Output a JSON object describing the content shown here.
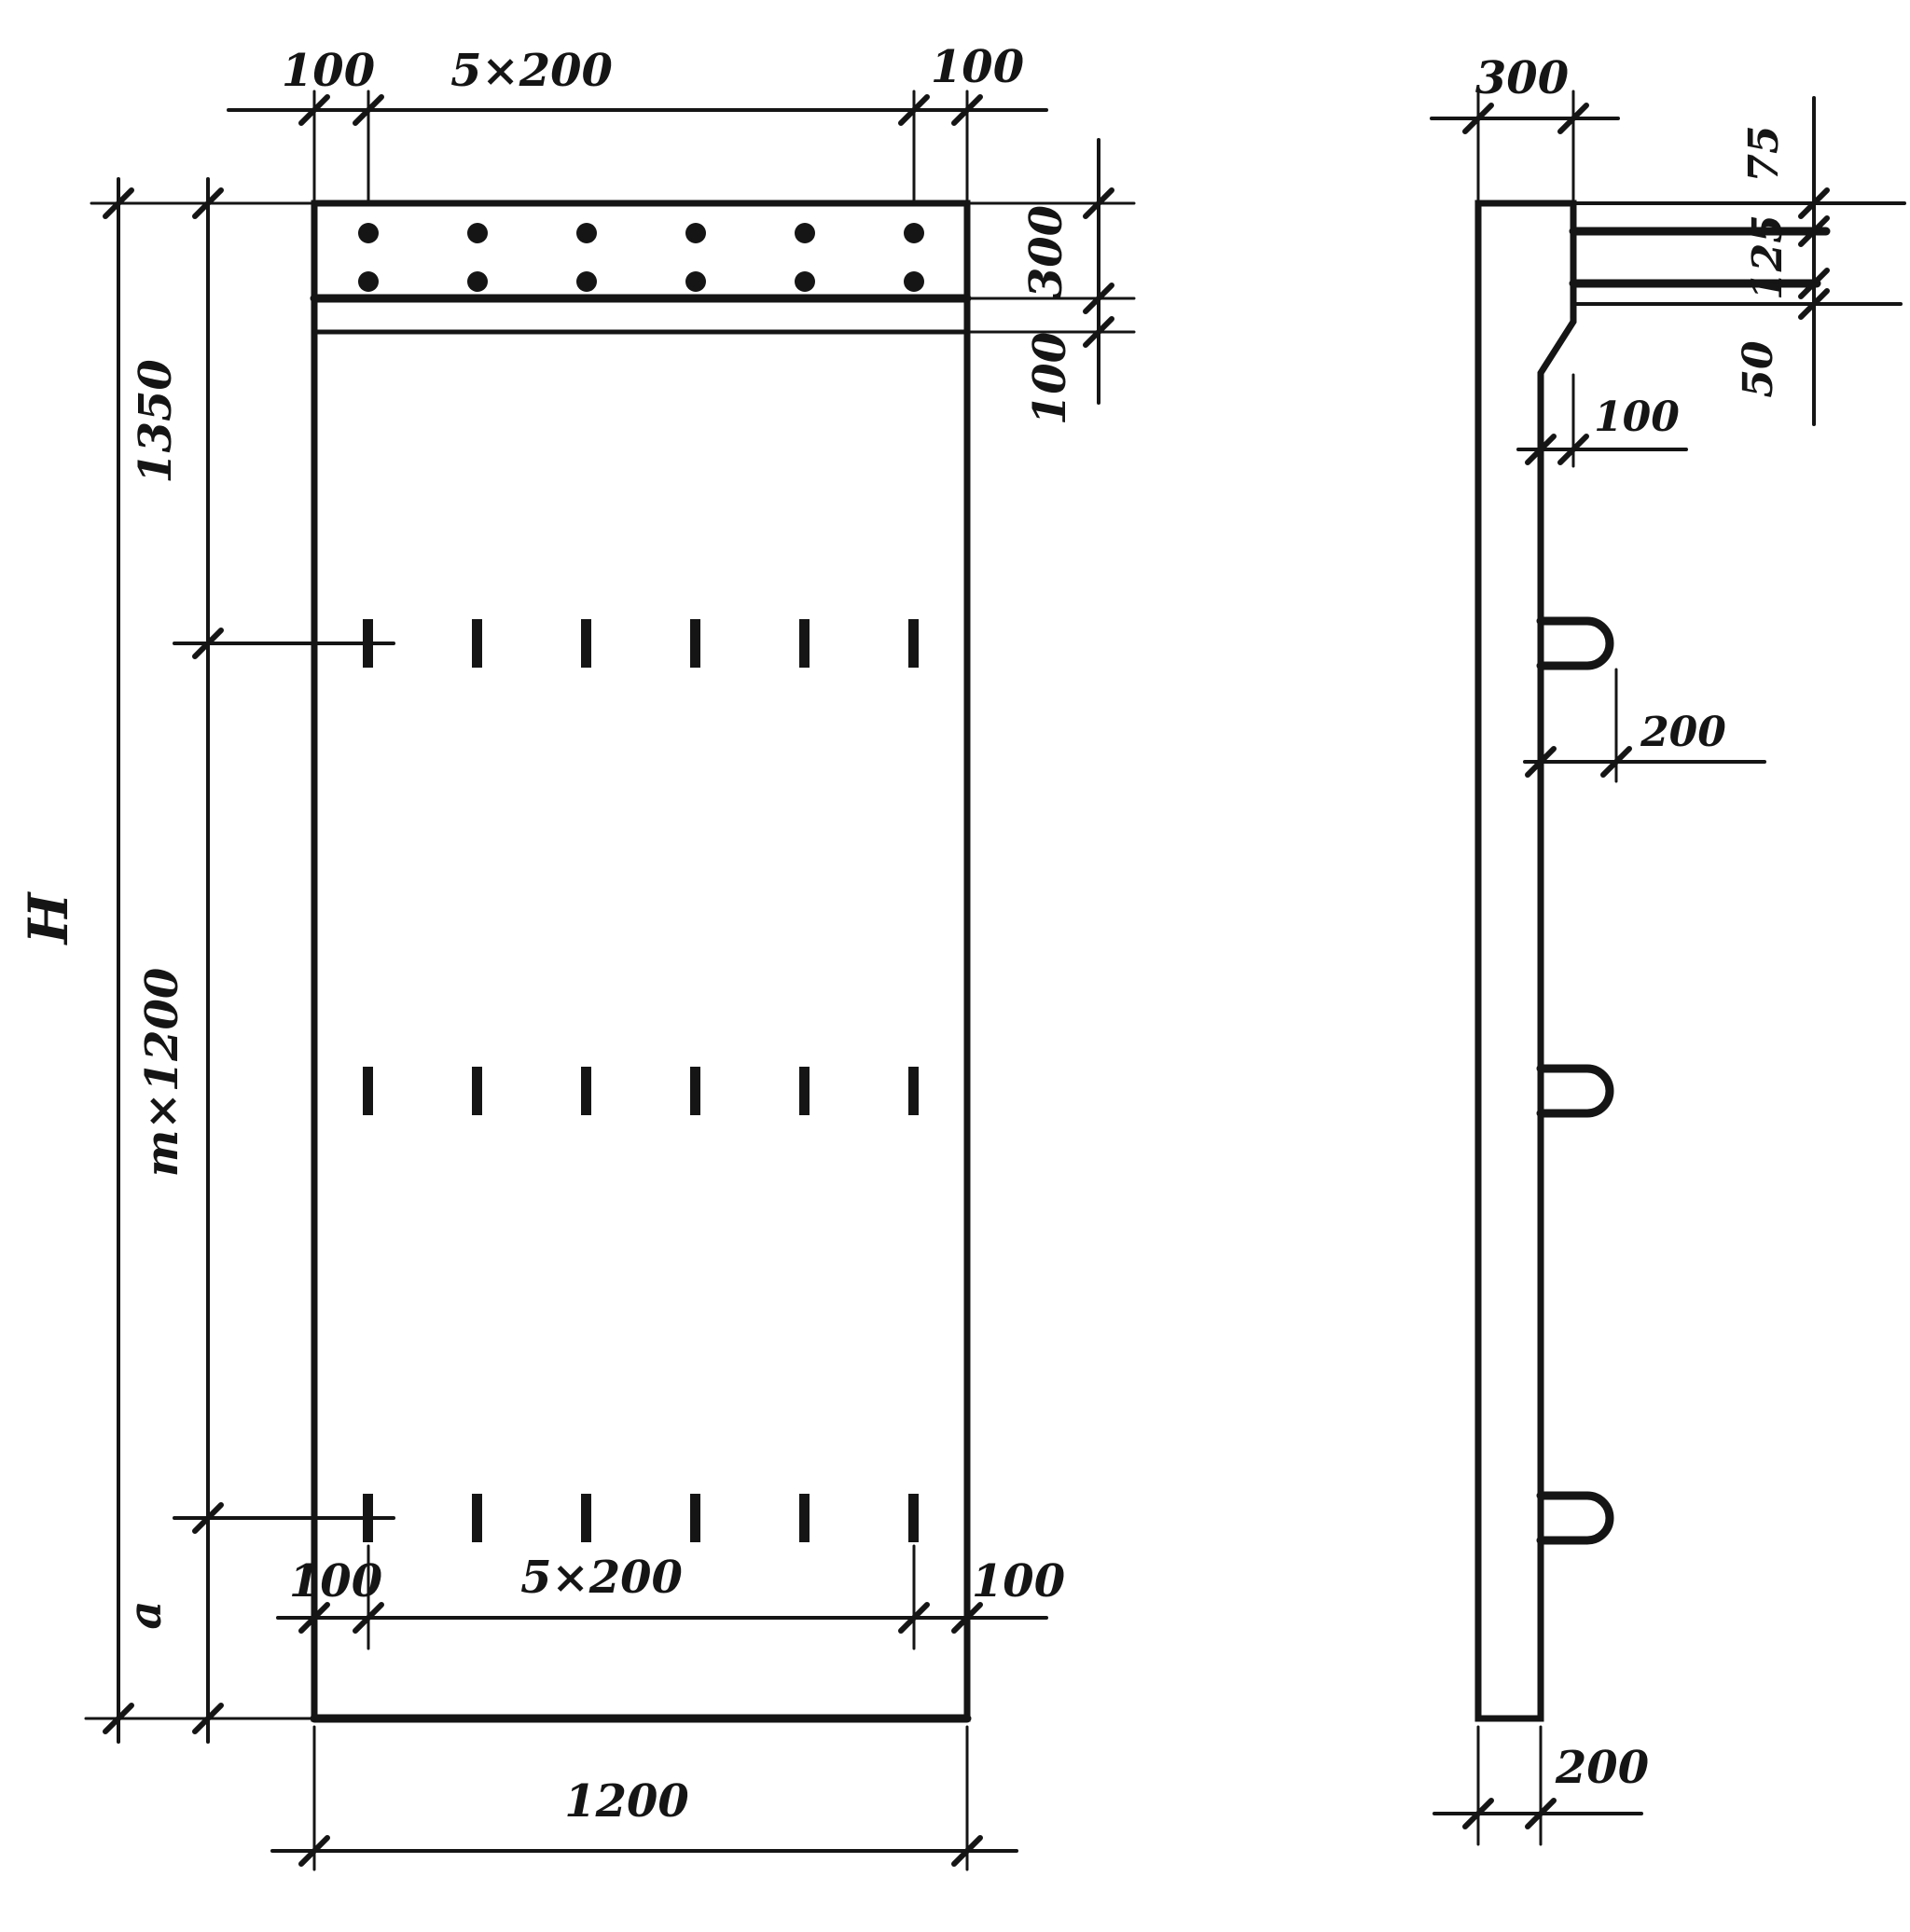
{
  "front_view": {
    "top_dims": {
      "left_margin": "100",
      "spacing": "5×200",
      "right_margin": "100"
    },
    "right_dims": {
      "cap_height": "300",
      "strip_height": "100"
    },
    "left_dims": {
      "overall_height": "H",
      "top_segment": "1350",
      "middle_segment": "m×1200",
      "bottom_segment": "a"
    },
    "bottom_inner_dims": {
      "left_margin": "100",
      "spacing": "5×200",
      "right_margin": "100"
    },
    "overall_width": "1200"
  },
  "side_view": {
    "top_width": "300",
    "dowel_spacing": {
      "first": "75",
      "second": "125",
      "third": "50"
    },
    "ledge_depth": "100",
    "loop_projection": "200",
    "panel_thickness": "200"
  },
  "colors": {
    "ink": "#151515",
    "paper": "#ffffff"
  }
}
